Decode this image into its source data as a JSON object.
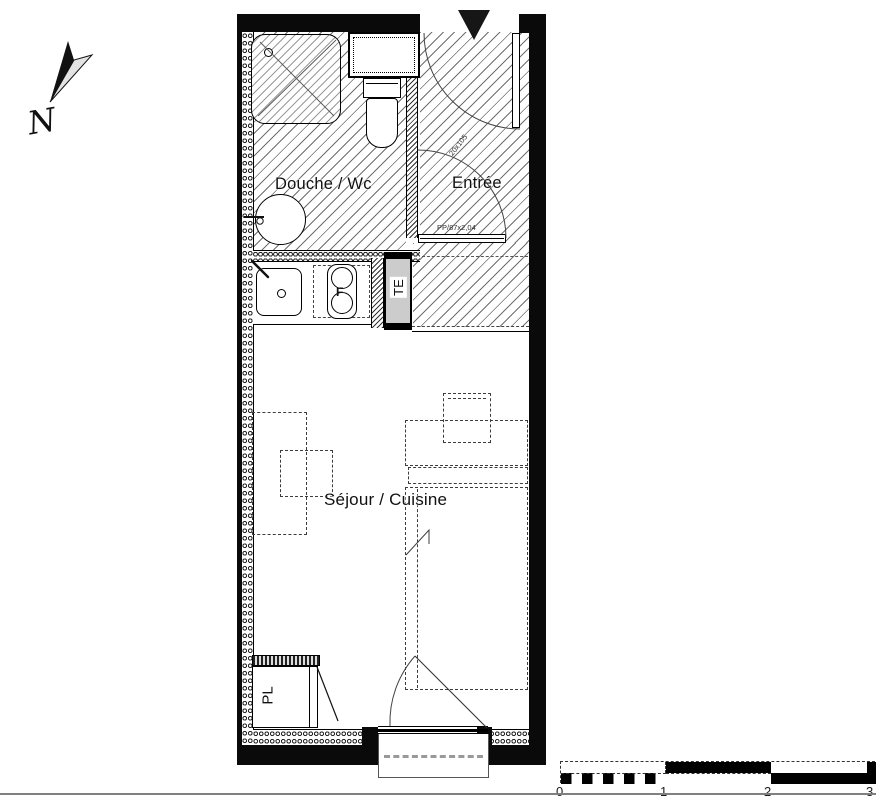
{
  "title": "Studio apartment floor plan",
  "north": {
    "label": "N"
  },
  "rooms": {
    "bathroom": {
      "label": "Douche / Wc"
    },
    "entry": {
      "label": "Entrée"
    },
    "living": {
      "label": "Séjour / Cuisine"
    },
    "closet": {
      "label": "PL"
    },
    "electrical_panel": {
      "label": "TE"
    }
  },
  "fixtures": {
    "hob_label": "F"
  },
  "annotations": {
    "entry_door": "PP/87x2,04",
    "duct_size": "20x105"
  },
  "scale_bar": {
    "ticks": [
      "0",
      "1",
      "2",
      "3"
    ],
    "unit_px": 105
  },
  "colors": {
    "wall": "#0a0a0a",
    "panel_fill": "#cccccc",
    "hatch_line": "#6e6e6e"
  }
}
